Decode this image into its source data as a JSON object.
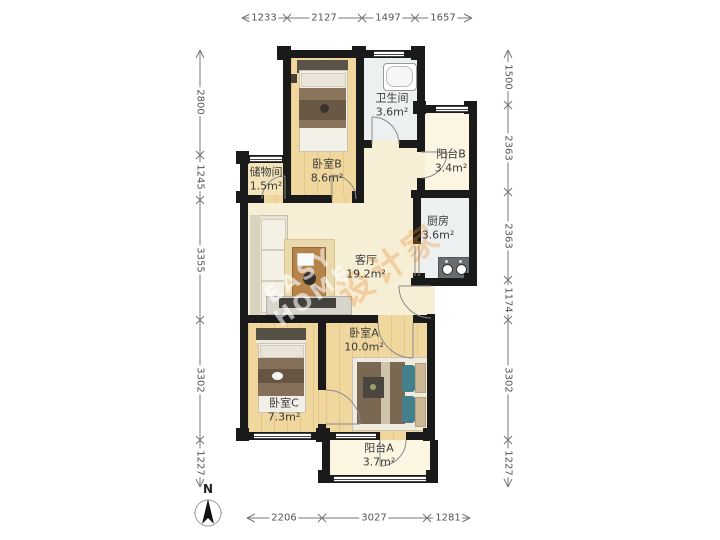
{
  "compass": {
    "label": "N"
  },
  "dims": {
    "top": [
      "1233",
      "2127",
      "1497",
      "1657"
    ],
    "bottom": [
      "2206",
      "3027",
      "1281"
    ],
    "left": [
      "2800",
      "1245",
      "3355",
      "3302",
      "1227"
    ],
    "right": [
      "1500",
      "2363",
      "2363",
      "1174",
      "3302",
      "1227"
    ]
  },
  "rooms": {
    "bedroom_b": {
      "name": "卧室B",
      "area": "8.6m²"
    },
    "bathroom": {
      "name": "卫生间",
      "area": "3.6m²"
    },
    "balcony_b": {
      "name": "阳台B",
      "area": "3.4m²"
    },
    "kitchen": {
      "name": "厨房",
      "area": "3.6m²"
    },
    "storage": {
      "name": "储物间",
      "area": "1.5m²"
    },
    "living": {
      "name": "客厅",
      "area": "19.2m²"
    },
    "bedroom_a": {
      "name": "卧室A",
      "area": "10.0m²"
    },
    "bedroom_c": {
      "name": "卧室C",
      "area": "7.3m²"
    },
    "balcony_a": {
      "name": "阳台A",
      "area": "3.7m²"
    }
  },
  "watermark": {
    "line1": "EASY",
    "line2": "HOME",
    "brand": "设计家"
  },
  "colors": {
    "wall": "#1a1a1a",
    "wood_floor": "#f0d79e",
    "living_floor": "#f7eed6",
    "tile_floor": "#edf0f1",
    "balcony_floor": "#fbf5e1",
    "watermark_orange": "#e8882a"
  }
}
